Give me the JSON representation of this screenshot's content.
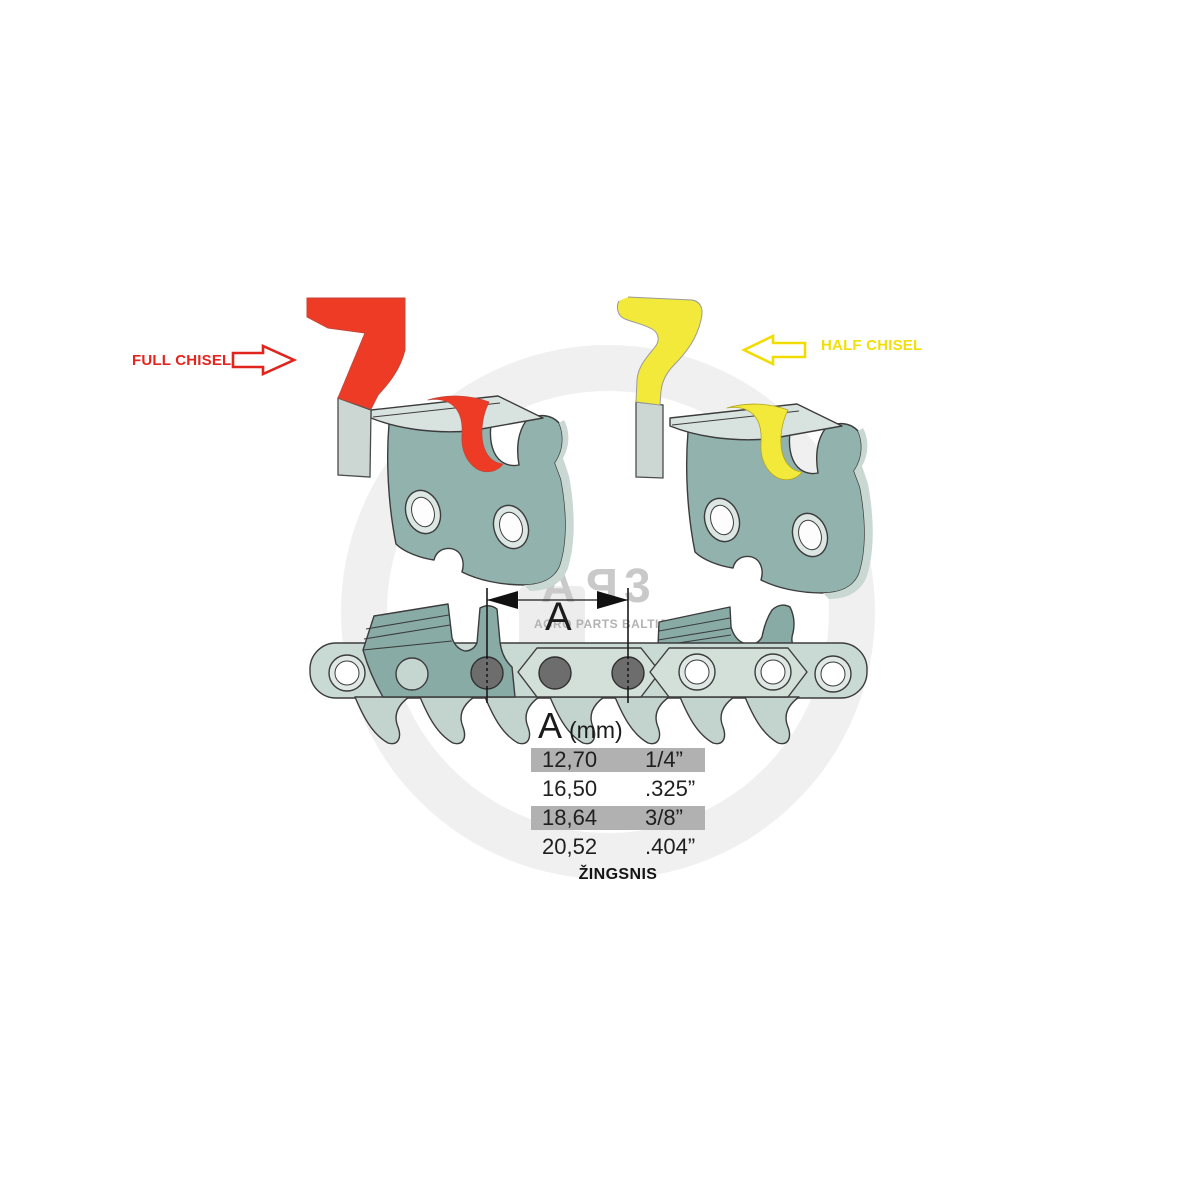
{
  "labels": {
    "full_chisel": "FULL CHISEL",
    "half_chisel": "HALF CHISEL"
  },
  "dimension": {
    "label": "A"
  },
  "pitch_table": {
    "header": {
      "letter": "A",
      "unit": "(mm)"
    },
    "rows": [
      {
        "mm": "12,70",
        "inch": "1/4”"
      },
      {
        "mm": "16,50",
        "inch": ".325”"
      },
      {
        "mm": "18,64",
        "inch": "3/8”"
      },
      {
        "mm": "20,52",
        "inch": ".404”"
      }
    ],
    "caption": "ŽINGSNIS"
  },
  "watermark": {
    "letters": [
      "A",
      "P",
      "3"
    ],
    "subtitle": "AGRO PARTS BALTIJA"
  },
  "colors": {
    "full_chisel_red": "#ed3b25",
    "half_chisel_yellow": "#f3e93a",
    "label_red": "#e6251f",
    "label_yellow": "#f2df08",
    "steel_dark": "#88aba6",
    "steel_light": "#c9d9d3",
    "rivet_dark": "#6d6d6d",
    "table_highlight": "#b1b1b1",
    "watermark_gray": "#c9c9c9"
  }
}
